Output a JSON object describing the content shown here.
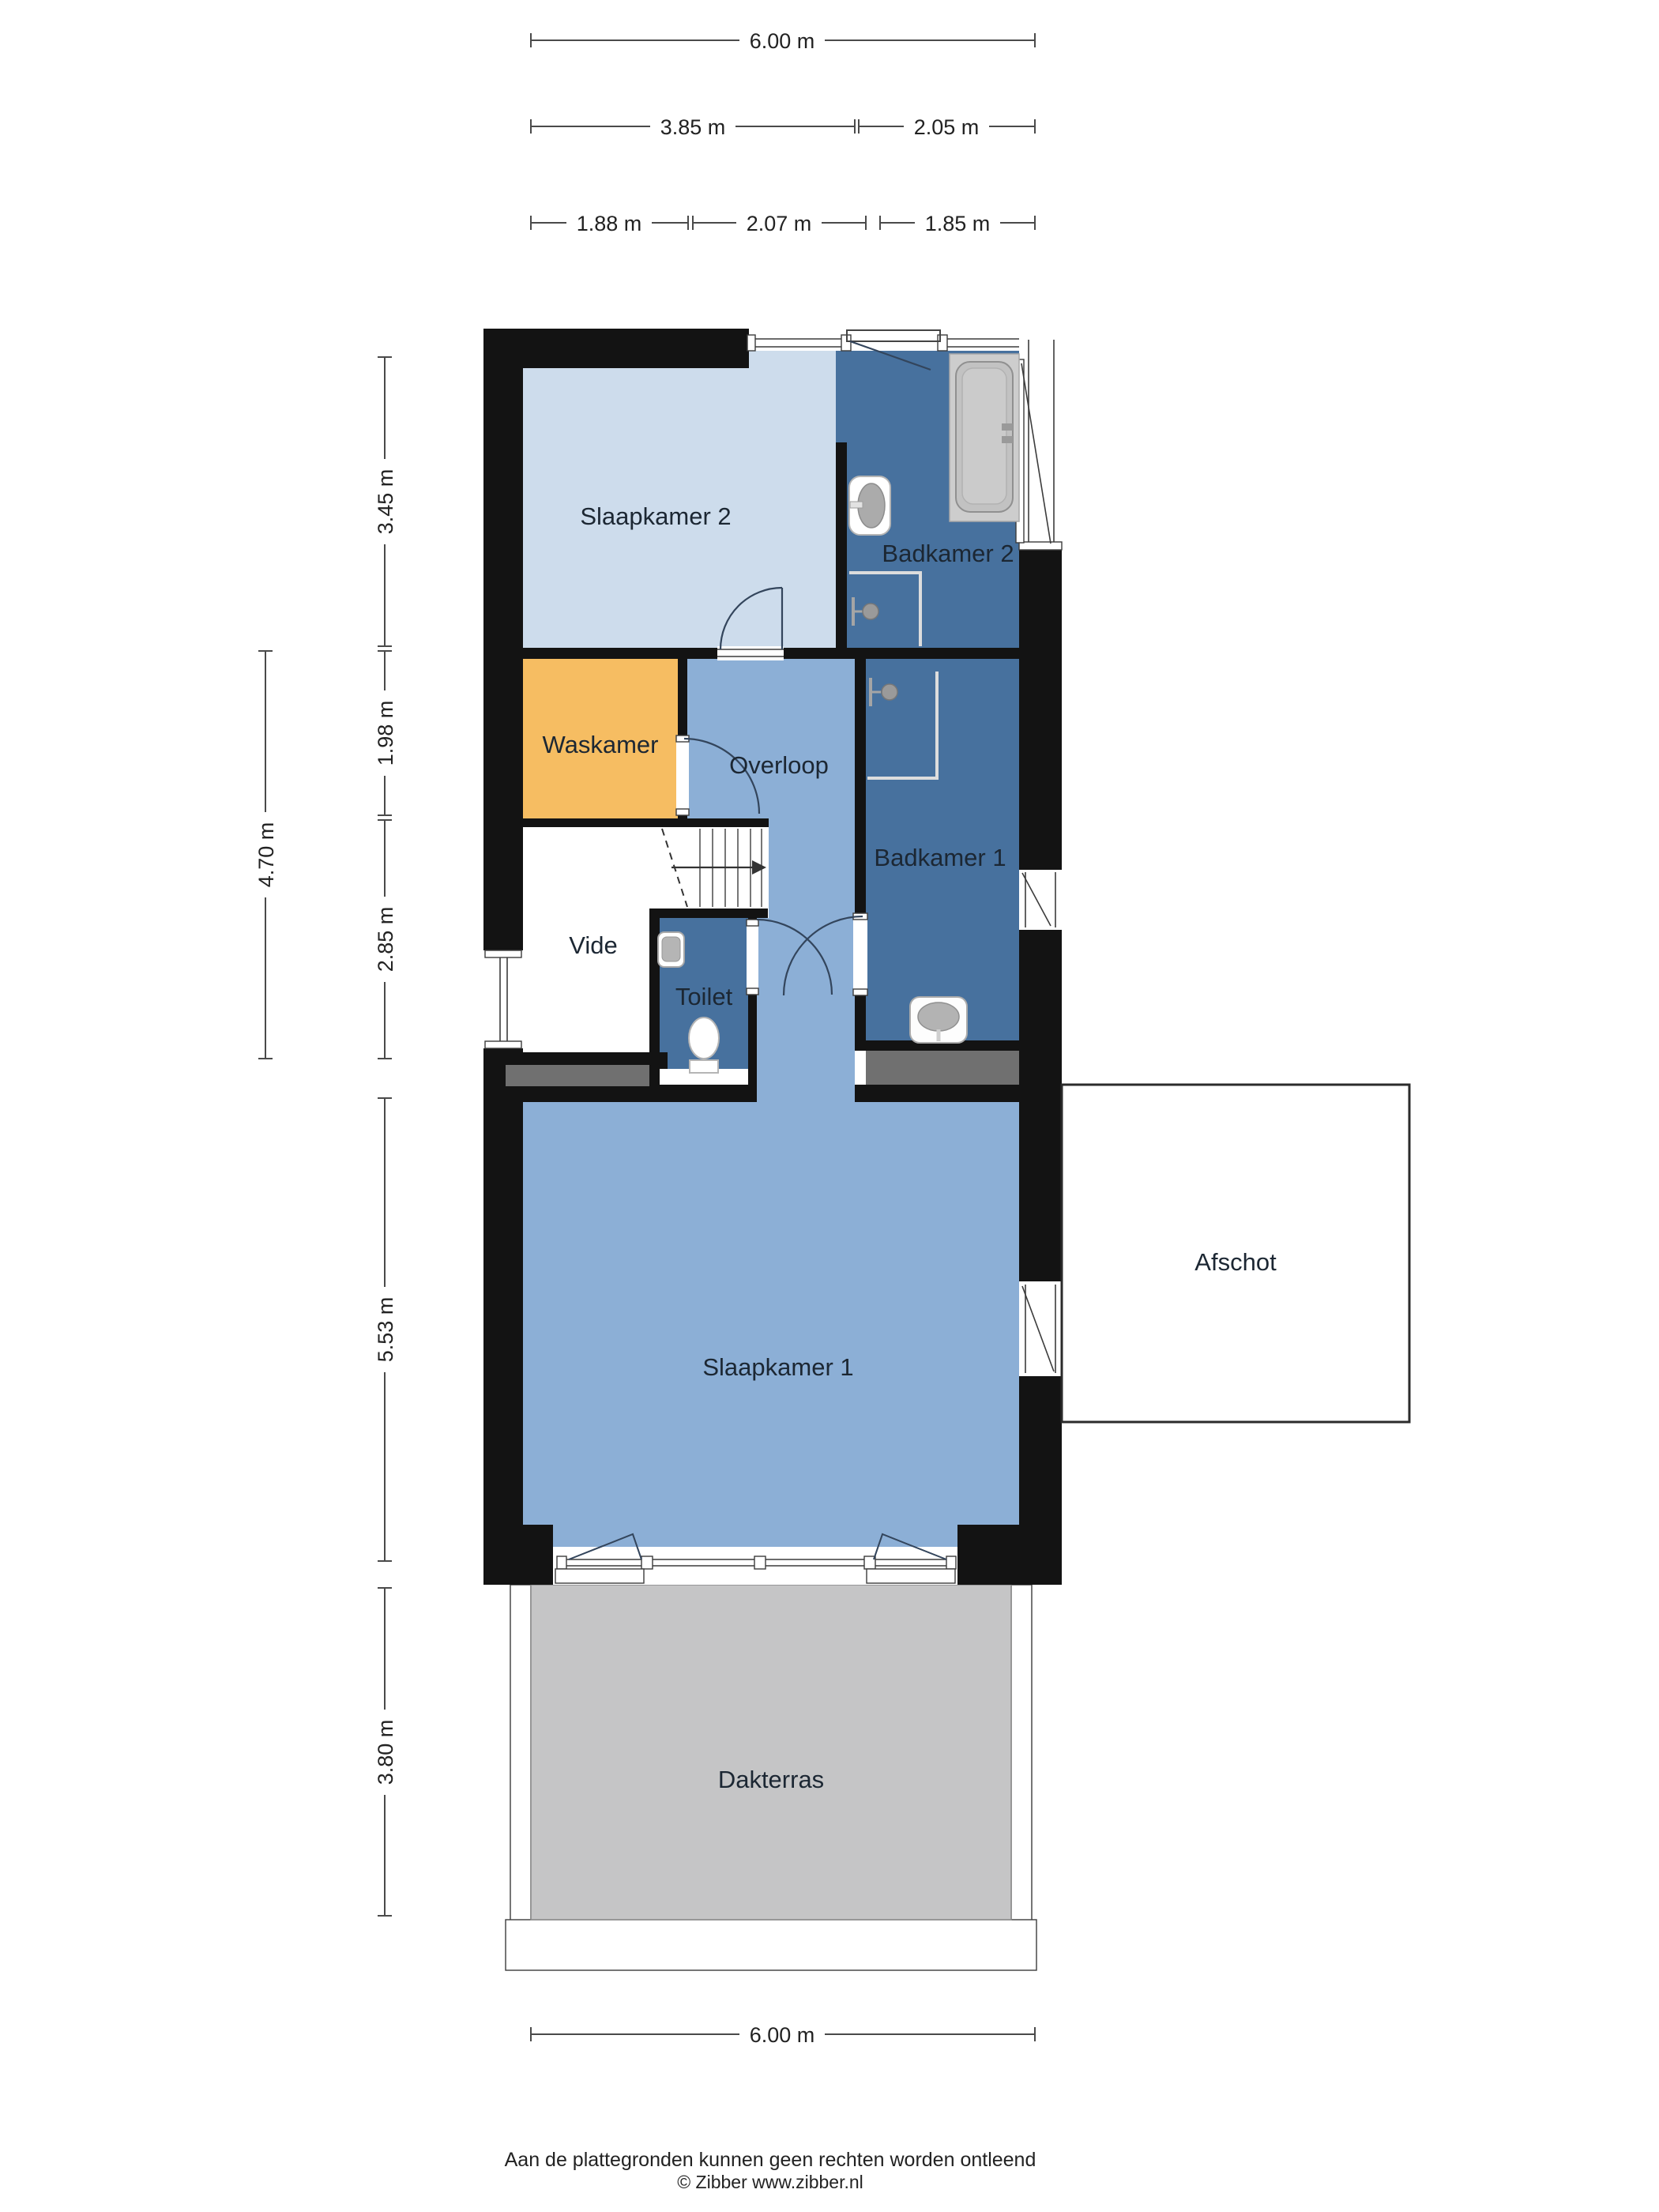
{
  "page": {
    "footer_line1": "Aan de plattegronden kunnen geen rechten worden ontleend",
    "footer_line2": "© Zibber www.zibber.nl"
  },
  "colors": {
    "wall": "#131313",
    "bedroom_light": "#cddcec",
    "bath_dark": "#47719e",
    "hall_mid": "#8cafd6",
    "laundry_orange": "#f6bd62",
    "terrace_gray": "#c5c5c6",
    "mat_gray": "#707070",
    "fixture_white": "#ffffff",
    "fixture_gray": "#b9b9b9"
  },
  "rooms": {
    "slaapkamer2": {
      "label": "Slaapkamer 2"
    },
    "badkamer2": {
      "label": "Badkamer 2"
    },
    "waskamer": {
      "label": "Waskamer"
    },
    "overloop": {
      "label": "Overloop"
    },
    "badkamer1": {
      "label": "Badkamer 1"
    },
    "vide": {
      "label": "Vide"
    },
    "toilet": {
      "label": "Toilet"
    },
    "slaapkamer1": {
      "label": "Slaapkamer 1"
    },
    "afschot": {
      "label": "Afschot"
    },
    "dakterras": {
      "label": "Dakterras"
    }
  },
  "dimensions": {
    "top": [
      {
        "label": "6.00 m"
      },
      {
        "label": "3.85 m"
      },
      {
        "label": "2.05 m"
      },
      {
        "label": "1.88 m"
      },
      {
        "label": "2.07 m"
      },
      {
        "label": "1.85 m"
      }
    ],
    "left": [
      {
        "label": "3.45 m"
      },
      {
        "label": "1.98 m"
      },
      {
        "label": "2.85 m"
      },
      {
        "label": "4.70 m"
      },
      {
        "label": "5.53 m"
      },
      {
        "label": "3.80 m"
      }
    ],
    "bottom": [
      {
        "label": "6.00 m"
      }
    ]
  }
}
